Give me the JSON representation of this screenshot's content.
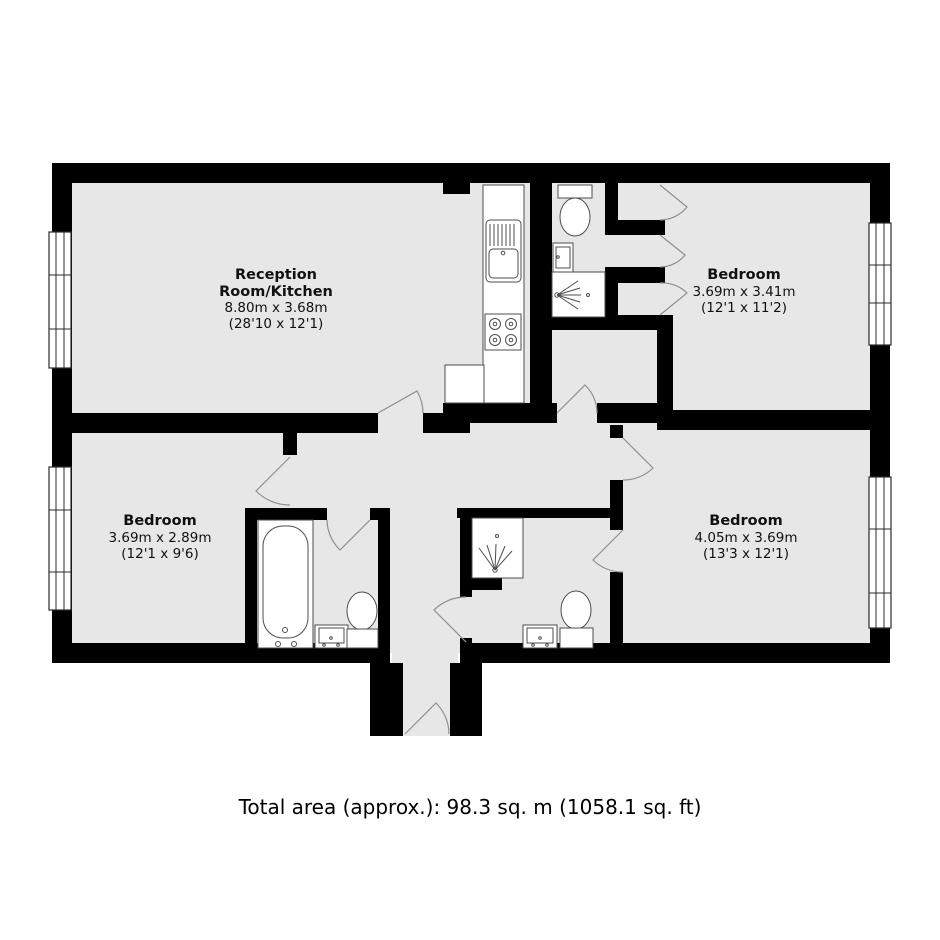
{
  "plan": {
    "type": "floorplan",
    "colors": {
      "floor": "#e7e7e7",
      "wall": "#000000",
      "fixture_stroke": "#4d4d4d",
      "door_arc": "#8f8f8f",
      "background": "#ffffff",
      "text": "#111111"
    },
    "rooms": [
      {
        "id": "reception-kitchen",
        "name": "Reception",
        "name2": "Room/Kitchen",
        "metric": "8.80m x 3.68m",
        "imperial": "(28'10 x 12'1)"
      },
      {
        "id": "bedroom-top-right",
        "name": "Bedroom",
        "metric": "3.69m x 3.41m",
        "imperial": "(12'1 x 11'2)"
      },
      {
        "id": "bedroom-bottom-left",
        "name": "Bedroom",
        "metric": "3.69m x 2.89m",
        "imperial": "(12'1 x 9'6)"
      },
      {
        "id": "bedroom-bottom-right",
        "name": "Bedroom",
        "metric": "4.05m x 3.69m",
        "imperial": "(13'3 x 12'1)"
      }
    ],
    "fixtures": [
      {
        "type": "kitchen-sink",
        "location": "kitchen-counter"
      },
      {
        "type": "hob",
        "location": "kitchen-counter"
      },
      {
        "type": "toilet",
        "location": "top-shower-room"
      },
      {
        "type": "sink",
        "location": "top-shower-room"
      },
      {
        "type": "shower",
        "location": "top-shower-room"
      },
      {
        "type": "bathtub",
        "location": "bathroom"
      },
      {
        "type": "sink",
        "location": "bathroom"
      },
      {
        "type": "toilet",
        "location": "bathroom"
      },
      {
        "type": "shower",
        "location": "bottom-shower-room"
      },
      {
        "type": "sink",
        "location": "bottom-shower-room"
      },
      {
        "type": "toilet",
        "location": "bottom-shower-room"
      }
    ],
    "windows": 4,
    "doors": 11
  },
  "footer": {
    "total_area": "Total area (approx.): 98.3 sq. m (1058.1 sq. ft)"
  }
}
